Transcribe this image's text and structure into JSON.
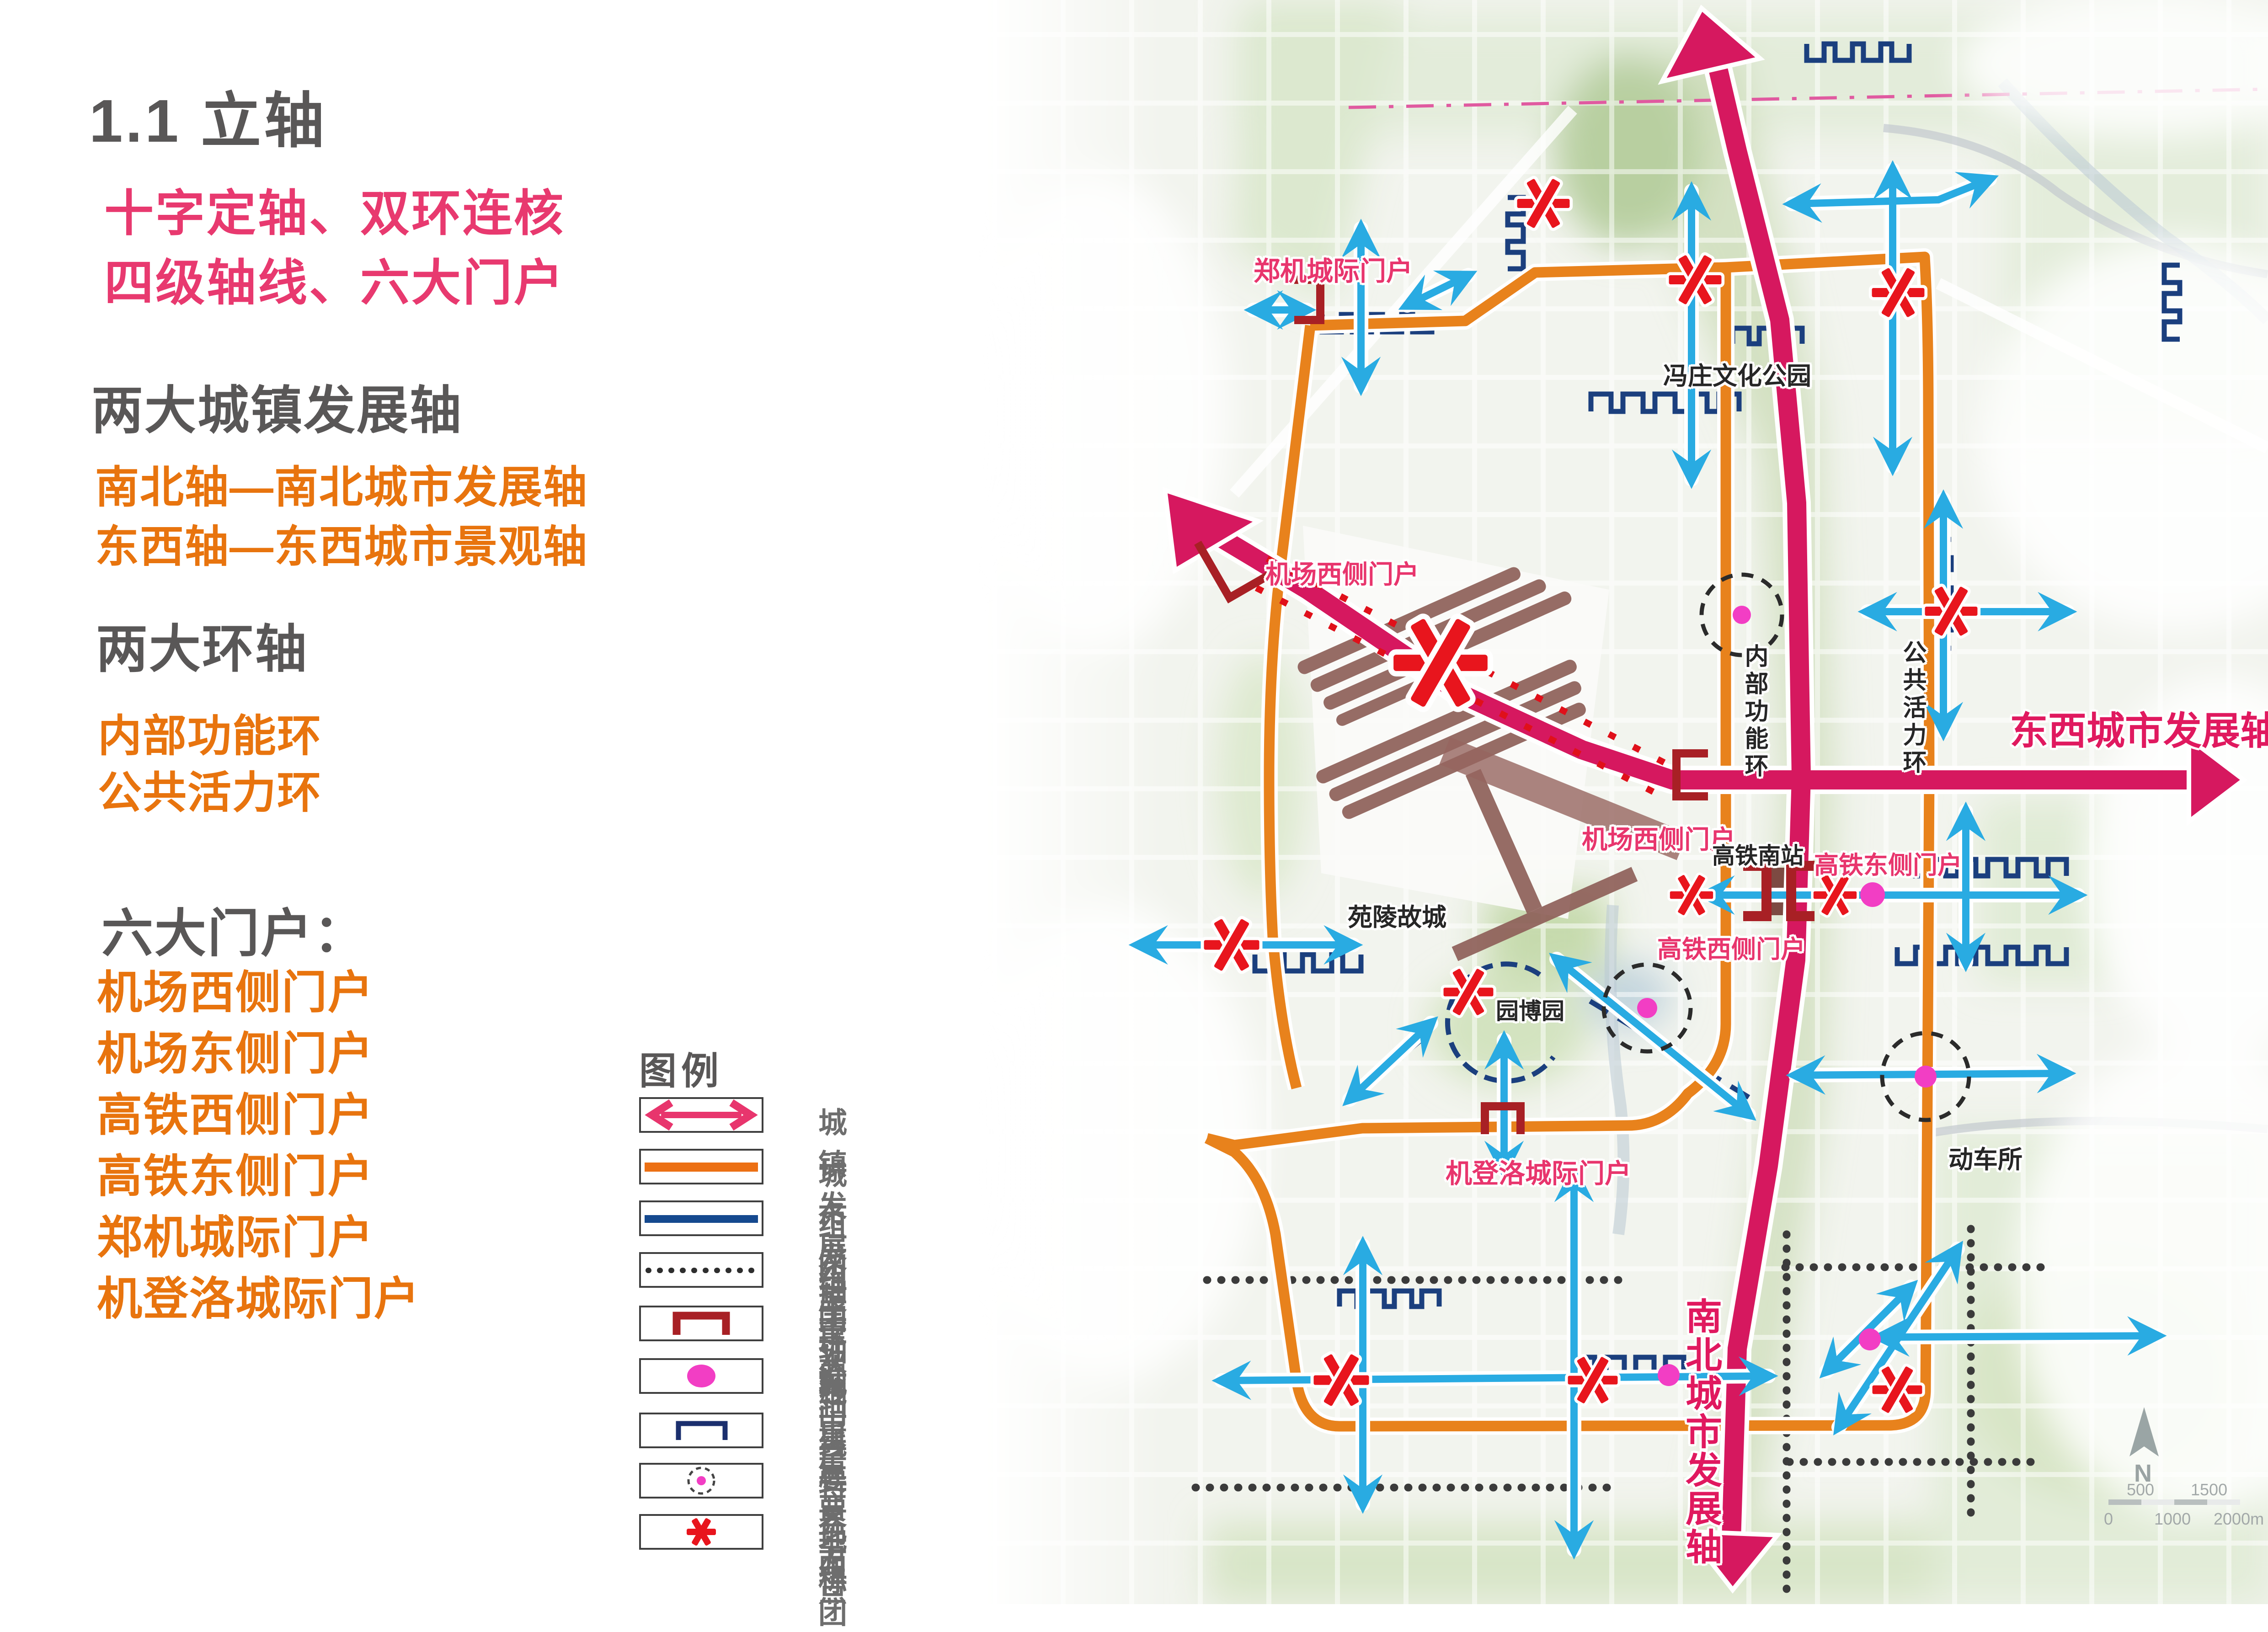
{
  "panel": {
    "title": "1.1 立轴",
    "slogans": [
      "十字定轴、双环连核",
      "四级轴线、六大门户"
    ],
    "sections": [
      {
        "heading": "两大城镇发展轴",
        "lines": [
          "南北轴—南北城市发展轴",
          "东西轴—东西城市景观轴"
        ]
      },
      {
        "heading": "两大环轴",
        "lines": [
          "内部功能环",
          "公共活力环"
        ]
      },
      {
        "heading": "六大门户：",
        "lines": [
          "机场西侧门户",
          "机场东侧门户",
          "高铁西侧门户",
          "高铁东侧门户",
          "郑机城际门户",
          "机登洛城际门户"
        ]
      }
    ]
  },
  "legend": {
    "title": "图例",
    "items": [
      {
        "label": "城镇发展轴",
        "icon": "pink-double-arrow"
      },
      {
        "label": "城市发展环轴",
        "icon": "orange-line"
      },
      {
        "label": "组团主轴线",
        "icon": "navy-line"
      },
      {
        "label": "组团次轴线",
        "icon": "dotted-line"
      },
      {
        "label": "重要门户",
        "icon": "dark-red-gate-bracket"
      },
      {
        "label": "城市重要节点",
        "icon": "magenta-dot"
      },
      {
        "label": "重要界面",
        "icon": "navy-bracket"
      },
      {
        "label": "特色组团",
        "icon": "dashed-circle"
      },
      {
        "label": "地标",
        "icon": "red-asterisk"
      }
    ]
  },
  "map": {
    "labels": {
      "zhengji_gateway": "郑机城际门户",
      "fengzhuang_park": "冯庄文化公园",
      "airport_west_gateway_1": "机场西侧门户",
      "airport_west_gateway_2": "机场西侧门户",
      "inner_function_ring": "内部功能环",
      "public_vitality_ring": "公共活力环",
      "ew_axis": "东西城市发展轴",
      "hsr_south_station": "高铁南站",
      "hsr_east_gateway": "高铁东侧门户",
      "hsr_west_gateway": "高铁西侧门户",
      "yuanling_city": "苑陵故城",
      "yuanbo_garden": "园博园",
      "jidengluo_gateway": "机登洛城际门户",
      "emu_depot": "动车所",
      "ns_axis": "南北城市发展轴"
    },
    "compass": "N",
    "scale_bar": {
      "ticks_top": [
        "500",
        "1500"
      ],
      "ticks_bottom": [
        "0",
        "1000",
        "2000m"
      ]
    },
    "colors": {
      "town_axis_pink": "#d6185f",
      "ring_orange": "#e8821c",
      "cluster_main_navy": "#1b3f7e",
      "gateway_dark_red": "#a82025",
      "node_magenta": "#f23ec4",
      "landmark_red": "#e8151d",
      "arrow_cyan": "#29abe2",
      "label_pink": "#e8356d",
      "heading_gray": "#595757",
      "text_orange": "#e8740e"
    }
  }
}
